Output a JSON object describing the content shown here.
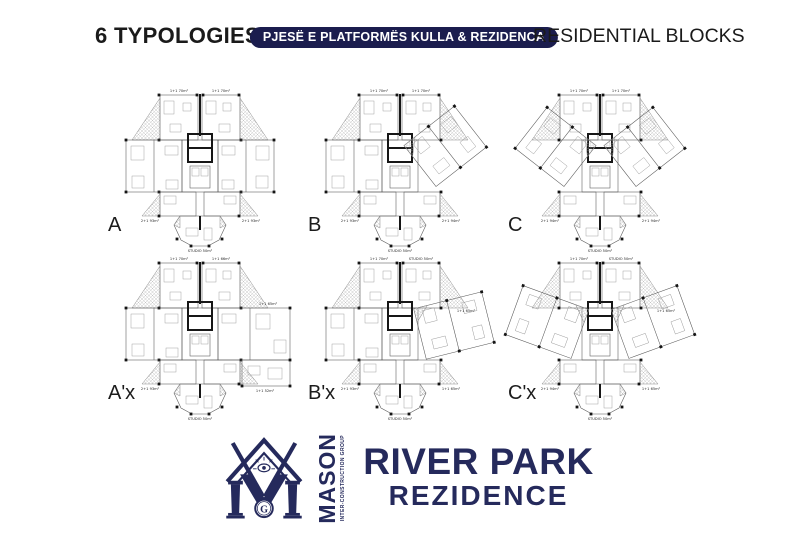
{
  "colors": {
    "navy": "#252a5c",
    "badge_bg": "#1b1d4e",
    "ink": "#1a1a1a"
  },
  "header": {
    "typologies_title": "6 TYPOLOGIES",
    "badge": "PJESË E PLATFORMËS KULLA & REZIDENCA",
    "blocks_title": "RESIDENTIAL BLOCKS"
  },
  "plans": [
    {
      "label": "A",
      "variant": "a",
      "units": {
        "top_left": "1+1 70m²",
        "top_right": "1+1 70m²",
        "bottom_left": "2+1 93m²",
        "bottom_right": "2+1 93m²",
        "studio": "STUDIO 50m²"
      }
    },
    {
      "label": "B",
      "variant": "b",
      "units": {
        "top_left": "1+1 70m²",
        "top_right": "1+1 70m²",
        "bottom_left": "2+1 93m²",
        "bottom_right": "2+1 94m²",
        "studio": "STUDIO 50m²"
      }
    },
    {
      "label": "C",
      "variant": "c",
      "units": {
        "top_left": "1+1 70m²",
        "top_right": "1+1 70m²",
        "bottom_left": "2+1 94m²",
        "bottom_right": "2+1 94m²",
        "studio": "STUDIO 50m²"
      }
    },
    {
      "label": "A'x",
      "variant": "ax",
      "units": {
        "top_left": "1+1 70m²",
        "top_right": "1+1 66m²",
        "wing": "1+1 65m²",
        "bottom_left": "2+1 93m²",
        "bottom_right": "1+1 52m²",
        "studio": "STUDIO 50m²"
      }
    },
    {
      "label": "B'x",
      "variant": "bx",
      "units": {
        "top_left": "1+1 70m²",
        "top_right": "STUDIO 50m²",
        "wing": "1+1 65m²",
        "bottom_left": "2+1 93m²",
        "bottom_right": "1+1 65m²",
        "studio": "STUDIO 50m²"
      }
    },
    {
      "label": "C'x",
      "variant": "cx",
      "units": {
        "top_left": "1+1 70m²",
        "top_right": "STUDIO 50m²",
        "wing": "1+1 65m²",
        "bottom_left": "2+1 94m²",
        "bottom_right": "1+1 65m²",
        "studio": "STUDIO 50m²"
      }
    }
  ],
  "logo": {
    "brand": "MASON",
    "brand_sub": "INTER-CONSTRUCTION GROUP",
    "monogram_letter": "G",
    "project_title": "RIVER PARK",
    "project_subtitle": "REZIDENCE"
  }
}
